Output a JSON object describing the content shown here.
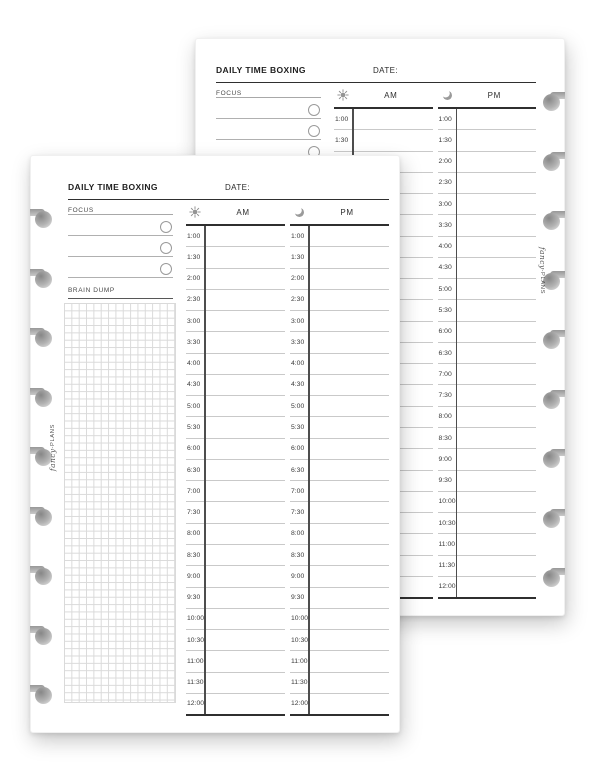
{
  "sheet": {
    "title": "DAILY TIME BOXING",
    "date_label": "DATE:",
    "focus_label": "FOCUS",
    "brain_dump_label": "BRAIN DUMP",
    "am_label": "AM",
    "pm_label": "PM",
    "am_icon": "sun-icon",
    "pm_icon": "moon-icon",
    "focus_slots": [
      "",
      "",
      ""
    ],
    "times": [
      "1:00",
      "1:30",
      "2:00",
      "2:30",
      "3:00",
      "3:30",
      "4:00",
      "4:30",
      "5:00",
      "5:30",
      "6:00",
      "6:30",
      "7:00",
      "7:30",
      "8:00",
      "8:30",
      "9:00",
      "9:30",
      "10:00",
      "10:30",
      "11:00",
      "11:30",
      "12:00"
    ]
  },
  "brand": {
    "script": "fancy",
    "separator": "-",
    "caps": "PLANS"
  },
  "pages": [
    {
      "name": "back-page",
      "binding": "right"
    },
    {
      "name": "front-page",
      "binding": "left"
    }
  ],
  "colors": {
    "page": "#ffffff",
    "line_strong": "#2f2f2f",
    "line_medium": "#4d4d4d",
    "line_light": "#c9c9c9",
    "grid_line": "#dadada",
    "icon_gray": "#949494",
    "hole_gray": "#a9a9a9"
  }
}
